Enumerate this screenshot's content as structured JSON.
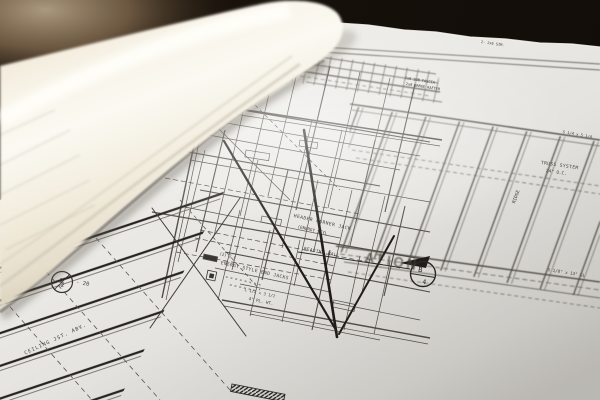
{
  "scene_colors": {
    "background_dark": "#17110b",
    "table_tan": "#a6947a",
    "rolled_paper": "#f8f4e8",
    "sheet_paper": "#ebeae6",
    "ink": "#514d46",
    "heavy_ink": "#1e1b18"
  },
  "labels": {
    "truss_system": "TRUSS SYSTEM",
    "truss_spacing": "24\" O.C.",
    "ridge": "RIDGE",
    "glulam": "5 1/8\" x 13\" GL",
    "psl": "5 1/4 x 5 1/4",
    "eave_note_1": "2x6 SUB FASCIA",
    "eave_note_2": "2x8 BARGE RAFTER",
    "border_note": "2- 2x6 SIM.",
    "header_corner_jack": "HEADER CORNER JACK",
    "energy_style": "(ENERGY STYL",
    "bearing_wall": "BEARING WALL",
    "qty_note": "(2) 2 x",
    "energy_end_jacks": "ENERGY STYLE END JACKS",
    "dim_row_1": "= = = = = = = =",
    "dim_row_2": "= = = = = =",
    "angle_note": "L 1/2 x 3 1/2",
    "plate_height": "4\" PL. HT.",
    "ceiling_joists": "CEILING JST. ABV.",
    "ghost_stamp": "ATION"
  },
  "section_marker": {
    "top": "B",
    "bottom": "4"
  },
  "spacing_bubble": {
    "fraction": "½",
    "note": "· 20"
  }
}
